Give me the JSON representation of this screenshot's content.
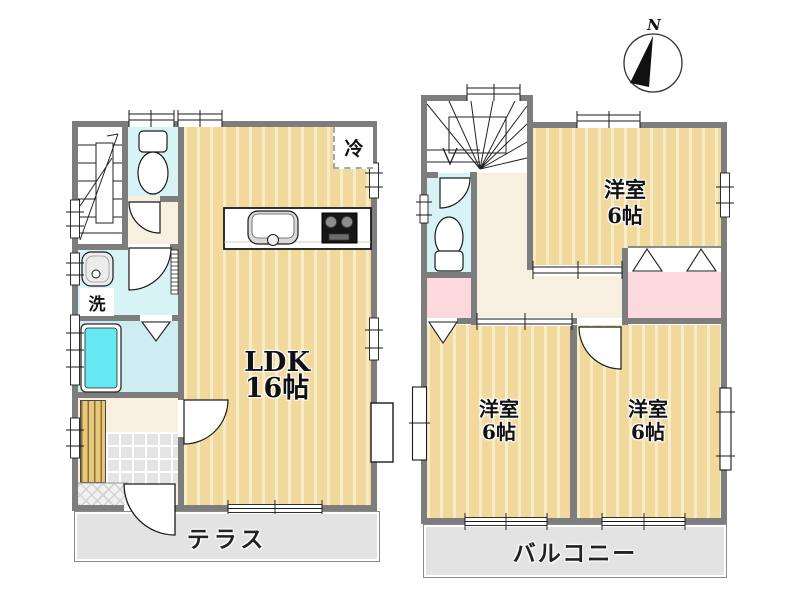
{
  "floor1": {
    "ldk": {
      "name": "LDK",
      "size": "16帖"
    },
    "fridge_label": "冷",
    "wash_label": "洗",
    "terrace_label": "テラス"
  },
  "floor2": {
    "rooms": [
      {
        "name": "洋室",
        "size": "6帖",
        "position": "top-right"
      },
      {
        "name": "洋室",
        "size": "6帖",
        "position": "bottom-left"
      },
      {
        "name": "洋室",
        "size": "6帖",
        "position": "bottom-right"
      }
    ],
    "balcony_label": "バルコニー"
  },
  "compass": {
    "label": "N"
  },
  "colors": {
    "wall": "#7d7d7d",
    "wood_floor": "#f1d99e",
    "hallway": "#f7efdf",
    "wet_area_cyan": "#d8f3f6",
    "bathroom_cyan": "#cdedf2",
    "bathtub_cyan": "#65e8f1",
    "closet_pink": "#fbd9dc",
    "deck_gray": "#e3e3e3"
  }
}
